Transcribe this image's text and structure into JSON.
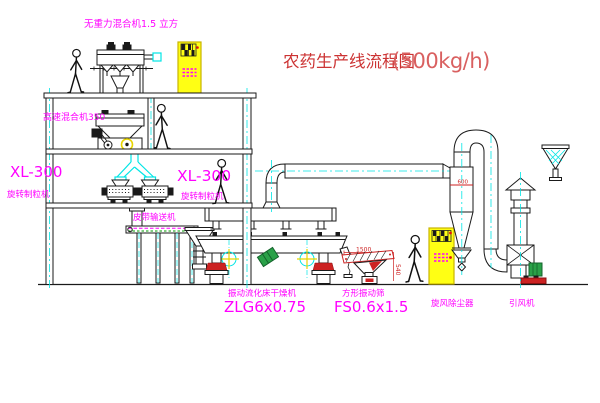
{
  "diagram": {
    "title": {
      "name": "农药生产线流程图",
      "capacity": "(500kg/h)"
    },
    "labels": {
      "gravity_mixer": "无重力混合机1.5 立方",
      "high_speed_mixer": "高速混合机350",
      "granulator_left_model": "XL-300",
      "granulator_left_name": "旋转制粒机",
      "granulator_right_model": "XL-300",
      "granulator_right_name": "旋转制粒机",
      "belt_conveyor": "皮带输送机",
      "fluid_bed_dryer_name": "振动流化床干燥机",
      "fluid_bed_dryer_model": "ZLG6x0.75",
      "vibrating_screen_name": "方形振动筛",
      "vibrating_screen_model": "FS0.6x1.5",
      "cyclone": "旋风除尘器",
      "induced_draft_fan": "引风机"
    },
    "dimensions": {
      "screen_length": "1500",
      "screen_height": "540",
      "cyclone_dia": "600"
    },
    "colors": {
      "label_magenta": "#FF00FF",
      "title_red": "#CC3333",
      "line_black": "#1A1A1A",
      "centerline_cyan": "#00E5E5",
      "cabinet_yellow": "#FFFF14",
      "motor_green": "#2AA148",
      "accent_red": "#CC2222"
    }
  }
}
